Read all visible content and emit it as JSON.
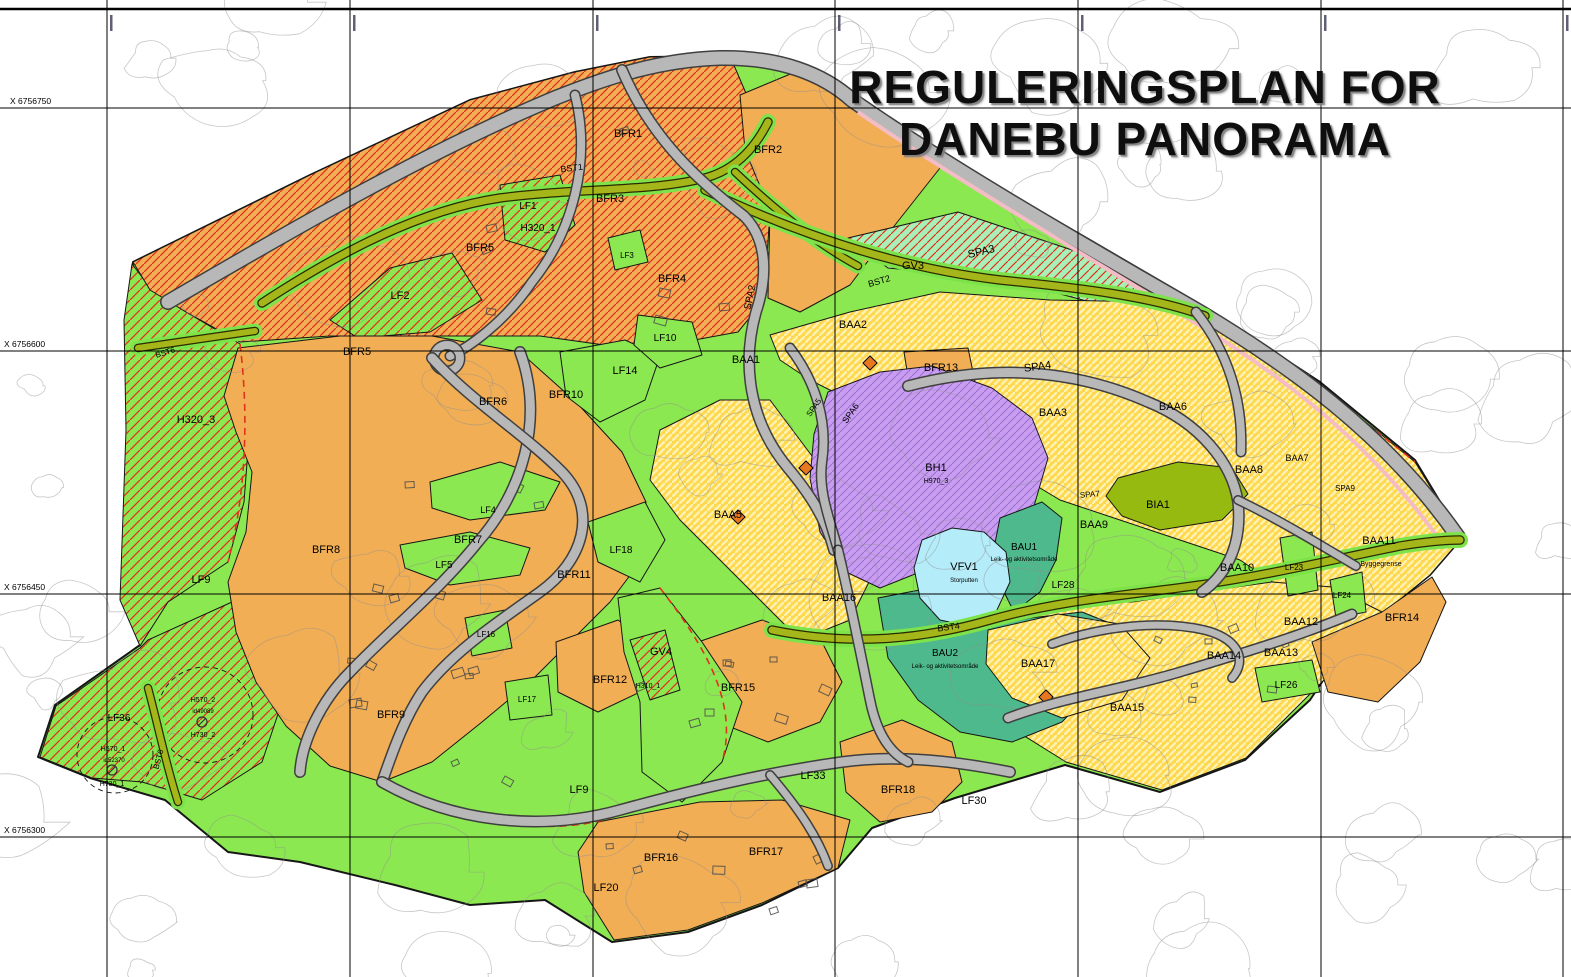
{
  "title": {
    "line1": "REGULERINGSPLAN FOR",
    "line2": "DANEBU PANORAMA"
  },
  "colors": {
    "green": "#8ce850",
    "green_dark_edge": "#161616",
    "orange": "#f2ae55",
    "red_hatch": "#e0321e",
    "yellow": "#ffd84d",
    "yellow_stripe": "#fdf2b3",
    "mint": "#a9f0b8",
    "purple": "#c89df0",
    "purple_hatch": "#9a6ed2",
    "teal": "#4db98c",
    "olive_field": "#97ba10",
    "water": "#b4ecf9",
    "road_gray": "#b8b8b8",
    "road_casing": "#3f3f3f",
    "road_olive": "#a4b619",
    "road_olive_casing": "#2a2a00",
    "road_margin_green": "#7ee24a",
    "pink_strip": "#f4bcc4",
    "contour": "#8f8f8f",
    "grid": "#000000",
    "symbol_orange": "#e87820"
  },
  "grid": {
    "v_lines": [
      107,
      350,
      593,
      835,
      1078,
      1321,
      1563
    ],
    "h_lines": [
      108,
      351,
      594,
      837
    ],
    "x_labels": [
      {
        "text": "X 6756750",
        "x": 10,
        "y": 104
      },
      {
        "text": "X 6756600",
        "x": 4,
        "y": 347
      },
      {
        "text": "X 6756450",
        "x": 4,
        "y": 590
      },
      {
        "text": "X 6756300",
        "x": 4,
        "y": 833
      }
    ],
    "frame_top_y": 9
  },
  "zones": [
    {
      "id": "plan-area",
      "fill": "green",
      "sw": 2,
      "pts": "133,262 310,175 470,100 575,72 650,57 730,56 800,70 845,95 960,165 1090,240 1210,310 1320,382 1415,460 1462,538 1430,575 1350,640 1310,700 1245,760 1160,792 1065,765 955,798 872,828 838,868 762,905 688,932 612,942 545,900 470,905 395,885 300,862 228,852 165,800 90,778 38,757 55,705 140,645 152,560 138,430 128,320"
    },
    {
      "id": "h320-3",
      "fill": "green-hatch",
      "pts": "132,264 152,290 186,312 240,344 250,424 244,502 228,562 168,602 140,646 120,600 126,430 124,320"
    },
    {
      "id": "sw-hatch",
      "fill": "green-hatch",
      "pts": "148,640 232,602 262,644 282,702 262,762 202,800 142,782 92,778 40,757 56,706 140,648"
    },
    {
      "id": "nw-band",
      "fill": "orange-hatch",
      "pts": "133,262 310,175 470,100 575,72 650,57 730,56 748,98 770,212 764,300 738,332 640,350 540,336 430,336 330,336 240,342 186,312 150,290"
    },
    {
      "id": "bfr2",
      "fill": "orange",
      "pts": "740,95 800,70 845,95 940,168 895,225 850,285 800,312 768,298 770,210 745,150"
    },
    {
      "id": "lf1-patch",
      "fill": "green-hatch",
      "pts": "500,185 560,175 575,225 545,252 505,240"
    },
    {
      "id": "lf2-patch",
      "fill": "green-hatch",
      "pts": "330,320 390,268 452,253 482,300 430,332 358,338"
    },
    {
      "id": "lf3-patch",
      "fill": "green",
      "pts": "608,238 640,230 648,262 615,270"
    },
    {
      "id": "gv3",
      "fill": "mint-hatch",
      "pts": "848,238 958,212 1078,252 1158,288 1128,312 1000,278 888,268"
    },
    {
      "id": "baa-upper",
      "fill": "yellow",
      "pts": "770,335 850,312 940,292 1050,300 1160,302 1250,342 1320,385 1415,462 1462,538 1430,575 1350,640 1300,600 1240,560 1180,540 1120,520 1060,500 1010,470 960,440 900,420 850,400 810,380 780,360"
    },
    {
      "id": "baa-mid",
      "fill": "yellow",
      "pts": "660,430 720,400 770,400 800,440 830,480 850,530 870,580 850,620 800,640 760,600 720,560 680,520 650,480"
    },
    {
      "id": "baa-lower",
      "fill": "yellow",
      "pts": "928,642 992,612 1060,602 1132,602 1200,592 1272,582 1332,587 1382,612 1352,652 1302,702 1246,758 1162,790 1066,762 1002,722 956,686"
    },
    {
      "id": "bfr-west",
      "fill": "orange",
      "pts": "238,348 340,336 432,336 520,352 576,402 622,452 646,502 640,562 610,602 570,642 530,682 482,722 432,762 382,782 330,766 286,726 256,682 236,632 228,582 246,532 252,472 236,432 224,396"
    },
    {
      "id": "bfr12",
      "fill": "orange",
      "pts": "556,642 618,620 660,652 640,692 598,712 558,692"
    },
    {
      "id": "bfr15",
      "fill": "orange",
      "pts": "698,642 762,620 822,642 842,682 820,722 768,742 718,722 694,682"
    },
    {
      "id": "bfr18",
      "fill": "orange",
      "pts": "840,742 902,720 952,742 962,782 932,812 880,822 846,792"
    },
    {
      "id": "bfr16-17",
      "fill": "orange",
      "pts": "598,822 700,802 782,800 850,820 838,868 762,903 688,930 614,940 584,892 578,852"
    },
    {
      "id": "bfr13",
      "fill": "orange",
      "pts": "904,352 968,348 978,396 912,402"
    },
    {
      "id": "bfr14",
      "fill": "orange",
      "pts": "1312,642 1382,612 1432,577 1446,602 1420,662 1378,702 1328,692"
    },
    {
      "id": "lf14-patch",
      "fill": "green",
      "pts": "560,352 625,340 660,356 645,400 600,422 566,396"
    },
    {
      "id": "lf10-patch",
      "fill": "green",
      "pts": "638,315 692,322 702,355 660,368 634,345"
    },
    {
      "id": "lf4-patch",
      "fill": "green",
      "pts": "430,482 500,462 560,482 545,510 470,520 432,508"
    },
    {
      "id": "lf5-patch",
      "fill": "green",
      "pts": "400,545 470,532 530,548 520,575 450,585 405,568"
    },
    {
      "id": "lf18-patch",
      "fill": "green",
      "pts": "588,522 645,502 665,540 640,582 598,562"
    },
    {
      "id": "lf16-patch",
      "fill": "green",
      "pts": "465,618 505,610 512,648 472,656"
    },
    {
      "id": "lf17-patch",
      "fill": "green",
      "pts": "505,682 548,675 552,715 510,720"
    },
    {
      "id": "gv4",
      "fill": "green",
      "pts": "618,598 660,588 702,642 742,702 722,762 682,802 642,772 640,702 624,652"
    },
    {
      "id": "h310-patch",
      "fill": "green-hatch",
      "pts": "630,640 665,630 680,690 650,700"
    },
    {
      "id": "bh1",
      "fill": "purple",
      "pts": "828,392 880,372 932,366 992,388 1032,418 1048,458 1034,506 1004,538 962,552 920,572 880,588 846,572 820,532 810,478 814,434"
    },
    {
      "id": "bau1",
      "fill": "teal",
      "pts": "1000,518 1042,502 1062,518 1056,560 1040,592 1014,612 998,580 994,548"
    },
    {
      "id": "bau2",
      "fill": "teal",
      "pts": "878,598 930,588 980,628 1030,618 1082,612 1122,628 1102,680 1062,722 1012,742 960,732 918,700 888,658"
    },
    {
      "id": "baa17",
      "fill": "yellow",
      "pts": "988,630 1058,614 1120,624 1150,658 1122,700 1062,718 1012,698 986,664"
    },
    {
      "id": "vfv1-lake",
      "fill": "water",
      "pts": "922,540 952,528 984,532 1006,552 1010,582 996,612 968,626 940,620 920,598 914,568"
    },
    {
      "id": "bia1",
      "fill": "olive",
      "pts": "1118,478 1178,462 1232,468 1248,494 1222,520 1160,530 1122,516 1106,496"
    },
    {
      "id": "lf23-patch",
      "fill": "green",
      "pts": "1280,538 1312,532 1318,590 1288,596"
    },
    {
      "id": "lf24-patch",
      "fill": "green",
      "pts": "1330,580 1362,572 1366,612 1336,618"
    },
    {
      "id": "lf26-patch",
      "fill": "green",
      "pts": "1255,668 1312,660 1320,692 1262,702"
    }
  ],
  "roads": [
    {
      "id": "spa3-main",
      "kind": "gray",
      "w": 13,
      "d": "M168,302 C300,225 430,150 555,98 C610,76 660,60 720,58 C780,57 823,74 852,100 C950,168 1080,243 1200,312 C1285,363 1385,432 1458,537"
    },
    {
      "id": "pink-strip",
      "kind": "pink",
      "w": 4,
      "d": "M858,112 C952,177 1080,252 1194,322 C1276,372 1370,440 1444,546"
    },
    {
      "id": "bst1",
      "kind": "olive",
      "w": 7,
      "d": "M262,303 C340,252 420,210 500,198 C575,188 650,192 705,178 C735,170 755,148 768,122"
    },
    {
      "id": "bst1-link",
      "kind": "olive",
      "w": 6,
      "d": "M735,172 C770,205 815,243 858,266"
    },
    {
      "id": "bst2",
      "kind": "olive",
      "w": 7,
      "d": "M705,190 C800,235 900,268 1000,280 C1080,288 1150,296 1205,316"
    },
    {
      "id": "bst4",
      "kind": "olive",
      "w": 7,
      "d": "M772,630 C850,646 920,640 990,620 C1060,600 1130,595 1200,585 C1270,575 1340,558 1400,546 C1430,541 1448,540 1460,540"
    },
    {
      "id": "bst6-north",
      "kind": "olive",
      "w": 6,
      "d": "M138,348 L255,331"
    },
    {
      "id": "bst6-south",
      "kind": "olive",
      "w": 6,
      "d": "M148,688 C158,725 166,765 178,802"
    },
    {
      "id": "spa2",
      "kind": "gray",
      "w": 9,
      "d": "M622,70 C652,140 700,182 744,216 C770,242 766,282 756,312 C742,362 748,420 788,468 C808,492 826,518 834,550"
    },
    {
      "id": "skv-bfr3",
      "kind": "gray",
      "w": 8,
      "d": "M575,95 C592,162 572,232 532,282 C505,322 468,348 450,356"
    },
    {
      "id": "roundabout",
      "kind": "circle",
      "w": 8,
      "cx": 447,
      "cy": 358,
      "r": 13
    },
    {
      "id": "spa4",
      "kind": "gray",
      "w": 9,
      "d": "M908,386 C1000,362 1080,372 1148,402 C1198,422 1232,462 1238,502 C1242,540 1230,572 1202,592"
    },
    {
      "id": "spa9",
      "kind": "gray",
      "w": 7,
      "d": "M1238,500 C1280,520 1322,546 1356,566"
    },
    {
      "id": "skv-northeast",
      "kind": "gray",
      "w": 8,
      "d": "M1196,312 C1228,352 1243,400 1241,452"
    },
    {
      "id": "spa5-spa8",
      "kind": "gray",
      "w": 8,
      "d": "M790,348 C816,382 828,422 822,462 C818,492 830,520 838,550"
    },
    {
      "id": "skv-west1",
      "kind": "gray",
      "w": 9,
      "d": "M520,352 C545,420 522,492 478,542 C438,592 388,632 350,672 C320,702 302,742 300,772"
    },
    {
      "id": "skv-west2",
      "kind": "gray",
      "w": 9,
      "d": "M432,358 C472,402 522,432 562,472 C600,512 582,562 540,592 C498,622 452,652 422,692 C402,722 390,760 382,782"
    },
    {
      "id": "skv-south",
      "kind": "gray",
      "w": 9,
      "d": "M382,782 C452,822 540,832 620,810 C700,788 770,772 842,762 C900,754 960,762 1010,772"
    },
    {
      "id": "skv-bfr17",
      "kind": "gray",
      "w": 7,
      "d": "M770,775 C800,810 818,838 828,866"
    },
    {
      "id": "skv-mid",
      "kind": "gray",
      "w": 8,
      "d": "M838,550 C850,600 860,650 870,700 C876,730 888,752 908,762"
    },
    {
      "id": "skv-baa15",
      "kind": "gray",
      "w": 8,
      "d": "M1008,718 C1060,698 1120,690 1180,672 C1240,654 1300,636 1352,614"
    },
    {
      "id": "skv-baa15-loop",
      "kind": "gray",
      "w": 7,
      "d": "M1052,644 C1102,626 1160,620 1204,630 C1238,638 1248,660 1232,678"
    }
  ],
  "red_dashes": [
    "M240,344 C250,424 244,502 228,562",
    "M660,588 C700,640 740,700 722,762",
    "M398,788 C470,826 560,838 622,814",
    "M1160,302 C1250,342 1320,385 1415,462"
  ],
  "symbols": {
    "diamonds": [
      [
        870,
        363
      ],
      [
        806,
        468
      ],
      [
        738,
        517
      ],
      [
        1046,
        697
      ]
    ],
    "circle_slash": [
      [
        202,
        722
      ],
      [
        112,
        770
      ]
    ],
    "dashed_circles": [
      {
        "cx": 205,
        "cy": 715,
        "r": 48
      },
      {
        "cx": 115,
        "cy": 755,
        "r": 38
      }
    ]
  },
  "labels": [
    {
      "t": "BFR1",
      "x": 628,
      "y": 137,
      "s": 11
    },
    {
      "t": "BFR2",
      "x": 768,
      "y": 153,
      "s": 11
    },
    {
      "t": "BFR3",
      "x": 610,
      "y": 202,
      "s": 11
    },
    {
      "t": "BFR4",
      "x": 672,
      "y": 282,
      "s": 11
    },
    {
      "t": "BFR5",
      "x": 480,
      "y": 251,
      "s": 11
    },
    {
      "t": "BFR5",
      "x": 357,
      "y": 355,
      "s": 11
    },
    {
      "t": "LF1",
      "x": 528,
      "y": 209,
      "s": 10
    },
    {
      "t": "H320_1",
      "x": 538,
      "y": 231,
      "s": 10
    },
    {
      "t": "LF2",
      "x": 400,
      "y": 299,
      "s": 11
    },
    {
      "t": "LF3",
      "x": 627,
      "y": 258,
      "s": 8
    },
    {
      "t": "BST1",
      "x": 572,
      "y": 171,
      "s": 9,
      "r": -7
    },
    {
      "t": "BST2",
      "x": 880,
      "y": 284,
      "s": 9,
      "r": -16
    },
    {
      "t": "SPA3",
      "x": 982,
      "y": 255,
      "s": 11,
      "r": -13
    },
    {
      "t": "GV3",
      "x": 913,
      "y": 269,
      "s": 11
    },
    {
      "t": "SPA2",
      "x": 753,
      "y": 298,
      "s": 10,
      "r": -78
    },
    {
      "t": "BAA2",
      "x": 853,
      "y": 328,
      "s": 11
    },
    {
      "t": "BAA1",
      "x": 746,
      "y": 363,
      "s": 11
    },
    {
      "t": "LF10",
      "x": 665,
      "y": 341,
      "s": 10
    },
    {
      "t": "LF14",
      "x": 625,
      "y": 374,
      "s": 11
    },
    {
      "t": "BFR10",
      "x": 566,
      "y": 398,
      "s": 11
    },
    {
      "t": "BFR6",
      "x": 493,
      "y": 405,
      "s": 11
    },
    {
      "t": "H320_3",
      "x": 196,
      "y": 423,
      "s": 11
    },
    {
      "t": "BST6",
      "x": 166,
      "y": 355,
      "s": 8,
      "r": -17
    },
    {
      "t": "BFR13",
      "x": 941,
      "y": 371,
      "s": 11
    },
    {
      "t": "SPA4",
      "x": 1038,
      "y": 370,
      "s": 11,
      "r": -8
    },
    {
      "t": "BAA3",
      "x": 1053,
      "y": 416,
      "s": 11
    },
    {
      "t": "BAA6",
      "x": 1173,
      "y": 410,
      "s": 11
    },
    {
      "t": "SPA6",
      "x": 853,
      "y": 415,
      "s": 9,
      "r": -55
    },
    {
      "t": "SPA5",
      "x": 816,
      "y": 409,
      "s": 8,
      "r": -55
    },
    {
      "t": "BH1",
      "x": 936,
      "y": 471,
      "s": 11
    },
    {
      "t": "H970_3",
      "x": 936,
      "y": 483,
      "s": 7
    },
    {
      "t": "SPA7",
      "x": 1090,
      "y": 497,
      "s": 8,
      "r": -5
    },
    {
      "t": "BIA1",
      "x": 1158,
      "y": 508,
      "s": 11
    },
    {
      "t": "BAA8",
      "x": 1249,
      "y": 473,
      "s": 11
    },
    {
      "t": "BAA7",
      "x": 1297,
      "y": 461,
      "s": 9
    },
    {
      "t": "SPA9",
      "x": 1345,
      "y": 491,
      "s": 8
    },
    {
      "t": "BAA9",
      "x": 1094,
      "y": 528,
      "s": 11
    },
    {
      "t": "BAU1",
      "x": 1024,
      "y": 550,
      "s": 10
    },
    {
      "t": "Leik- og aktivitetsområde",
      "x": 1024,
      "y": 561,
      "s": 6
    },
    {
      "t": "VFV1",
      "x": 964,
      "y": 570,
      "s": 11
    },
    {
      "t": "Storputten",
      "x": 964,
      "y": 582,
      "s": 6
    },
    {
      "t": "LF28",
      "x": 1063,
      "y": 588,
      "s": 10
    },
    {
      "t": "BAA10",
      "x": 1237,
      "y": 571,
      "s": 11
    },
    {
      "t": "LF23",
      "x": 1294,
      "y": 570,
      "s": 8
    },
    {
      "t": "LF24",
      "x": 1342,
      "y": 598,
      "s": 8
    },
    {
      "t": "BAA11",
      "x": 1379,
      "y": 544,
      "s": 11
    },
    {
      "t": "Byggegrense",
      "x": 1381,
      "y": 566,
      "s": 7
    },
    {
      "t": "BAA16",
      "x": 839,
      "y": 601,
      "s": 11
    },
    {
      "t": "BST4",
      "x": 949,
      "y": 630,
      "s": 9,
      "r": -8
    },
    {
      "t": "BAU2",
      "x": 945,
      "y": 656,
      "s": 10
    },
    {
      "t": "Leik- og aktivitetsområde",
      "x": 945,
      "y": 668,
      "s": 6
    },
    {
      "t": "BAA17",
      "x": 1038,
      "y": 667,
      "s": 11
    },
    {
      "t": "BAA15",
      "x": 1127,
      "y": 711,
      "s": 11
    },
    {
      "t": "BAA14",
      "x": 1224,
      "y": 659,
      "s": 11
    },
    {
      "t": "BAA13",
      "x": 1281,
      "y": 656,
      "s": 11
    },
    {
      "t": "BAA12",
      "x": 1301,
      "y": 625,
      "s": 11
    },
    {
      "t": "LF26",
      "x": 1286,
      "y": 688,
      "s": 10
    },
    {
      "t": "BFR14",
      "x": 1402,
      "y": 621,
      "s": 11
    },
    {
      "t": "GV4",
      "x": 661,
      "y": 655,
      "s": 11
    },
    {
      "t": "H310_1",
      "x": 648,
      "y": 688,
      "s": 7
    },
    {
      "t": "BFR12",
      "x": 610,
      "y": 683,
      "s": 11
    },
    {
      "t": "BFR15",
      "x": 738,
      "y": 691,
      "s": 11
    },
    {
      "t": "LF16",
      "x": 486,
      "y": 637,
      "s": 8
    },
    {
      "t": "LF17",
      "x": 527,
      "y": 702,
      "s": 8
    },
    {
      "t": "BFR8",
      "x": 326,
      "y": 553,
      "s": 11
    },
    {
      "t": "BFR7",
      "x": 468,
      "y": 543,
      "s": 11
    },
    {
      "t": "LF4",
      "x": 488,
      "y": 513,
      "s": 9
    },
    {
      "t": "LF5",
      "x": 444,
      "y": 568,
      "s": 10
    },
    {
      "t": "BFR11",
      "x": 574,
      "y": 578,
      "s": 11
    },
    {
      "t": "LF18",
      "x": 621,
      "y": 553,
      "s": 10
    },
    {
      "t": "BAA5",
      "x": 728,
      "y": 518,
      "s": 11
    },
    {
      "t": "LF9",
      "x": 201,
      "y": 583,
      "s": 11
    },
    {
      "t": "LF9",
      "x": 579,
      "y": 793,
      "s": 11
    },
    {
      "t": "BFR9",
      "x": 391,
      "y": 718,
      "s": 11
    },
    {
      "t": "LF36",
      "x": 119,
      "y": 721,
      "s": 10
    },
    {
      "t": "H570_2",
      "x": 203,
      "y": 702,
      "s": 7
    },
    {
      "t": "id49089",
      "x": 203,
      "y": 713,
      "s": 6
    },
    {
      "t": "H730_2",
      "x": 203,
      "y": 737,
      "s": 7
    },
    {
      "t": "H570_1",
      "x": 113,
      "y": 751,
      "s": 7
    },
    {
      "t": "id52370",
      "x": 114,
      "y": 762,
      "s": 6
    },
    {
      "t": "H730_1",
      "x": 112,
      "y": 786,
      "s": 7
    },
    {
      "t": "BST6",
      "x": 161,
      "y": 760,
      "s": 8,
      "r": -75
    },
    {
      "t": "LF33",
      "x": 813,
      "y": 779,
      "s": 11
    },
    {
      "t": "BFR18",
      "x": 898,
      "y": 793,
      "s": 11
    },
    {
      "t": "LF30",
      "x": 974,
      "y": 804,
      "s": 11
    },
    {
      "t": "BFR16",
      "x": 661,
      "y": 861,
      "s": 11
    },
    {
      "t": "BFR17",
      "x": 766,
      "y": 855,
      "s": 11
    },
    {
      "t": "LF20",
      "x": 606,
      "y": 891,
      "s": 11
    }
  ]
}
